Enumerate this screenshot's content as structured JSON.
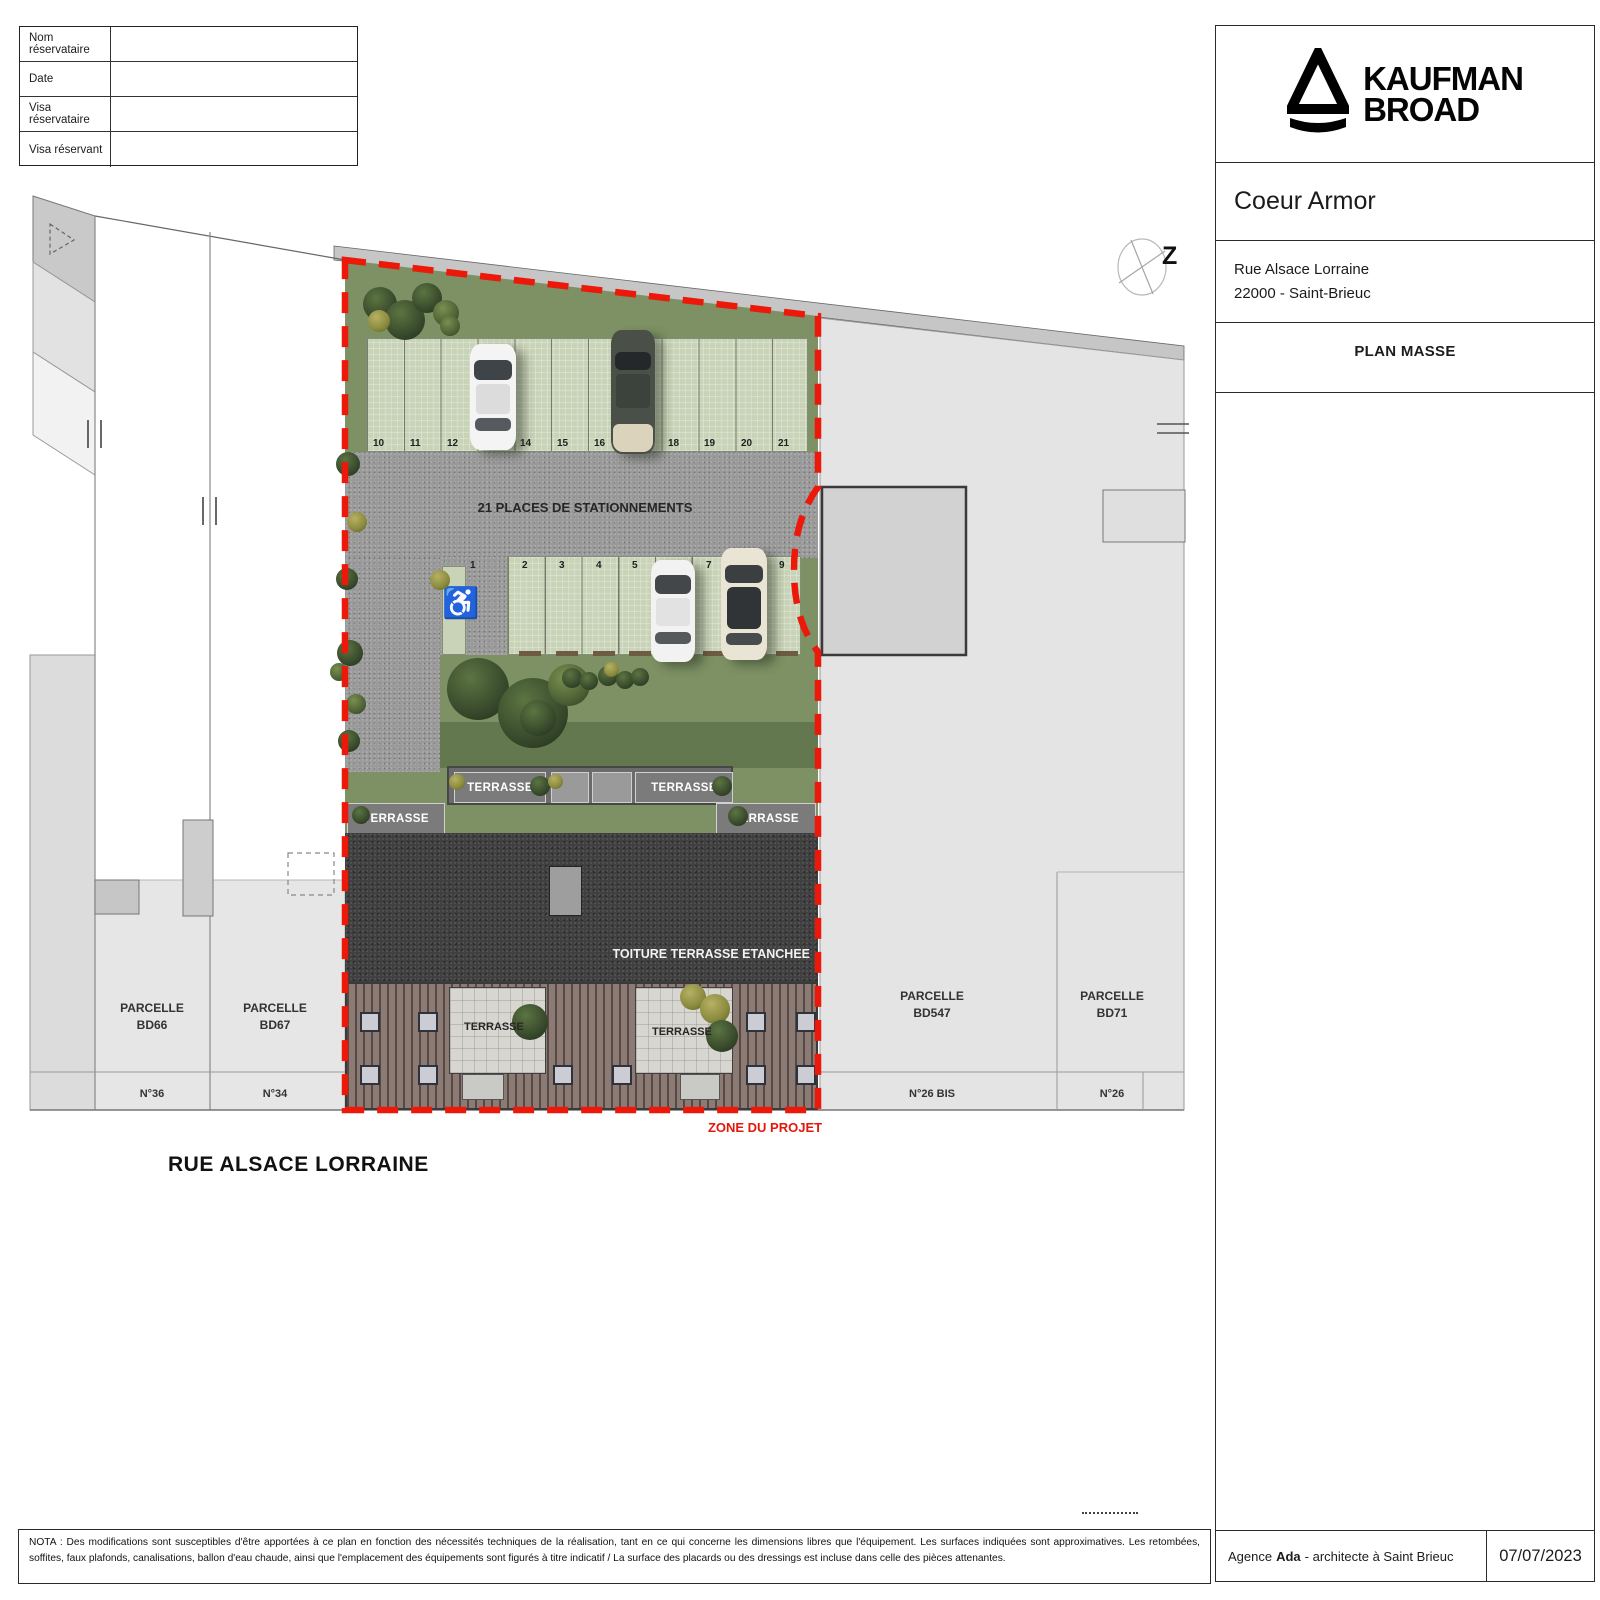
{
  "reservation_table": {
    "rows": [
      "Nom réservataire",
      "Date",
      "Visa réservataire",
      "Visa réservant"
    ]
  },
  "title_block": {
    "brand_top": "KAUFMAN",
    "brand_bottom": "BROAD",
    "project_name": "Coeur Armor",
    "address_line1": "Rue Alsace Lorraine",
    "address_line2": "22000 - Saint-Brieuc",
    "drawing_title": "PLAN MASSE",
    "agency_prefix": "Agence",
    "agency_name": "Ada",
    "agency_suffix": "- architecte à Saint Brieuc",
    "date": "07/07/2023"
  },
  "plan": {
    "parking_title": "21 PLACES DE STATIONNEMENTS",
    "top_stalls": [
      "10",
      "11",
      "12",
      "13",
      "14",
      "15",
      "16",
      "17",
      "18",
      "19",
      "20",
      "21"
    ],
    "bottom_stalls": [
      "1",
      "2",
      "3",
      "4",
      "5",
      "6",
      "7",
      "8",
      "9"
    ],
    "terrasse_label": "TERRASSE",
    "roof_label": "TOITURE TERRASSE ETANCHEE",
    "zone_label": "ZONE DU PROJET",
    "street_label": "RUE ALSACE LORRAINE",
    "north_letter": "Z",
    "icons": {
      "handicap": "♿"
    },
    "parcels": [
      {
        "label": "PARCELLE",
        "id": "BD66",
        "street_no": "N°36"
      },
      {
        "label": "PARCELLE",
        "id": "BD67",
        "street_no": "N°34"
      },
      {
        "label": "PARCELLE",
        "id": "BD547",
        "street_no": "N°26 BIS"
      },
      {
        "label": "PARCELLE",
        "id": "BD71",
        "street_no": "N°26"
      }
    ]
  },
  "nota": {
    "text": "NOTA :  Des modifications sont susceptibles d'être apportées à ce plan en fonction des nécessités techniques de la réalisation, tant en ce qui concerne les dimensions libres que l'équipement.  Les surfaces indiquées sont approximatives.  Les retombées, soffites, faux plafonds, canalisations, ballon d'eau chaude, ainsi que l'emplacement des équipements sont figurés à titre indicatif / La surface des placards ou des dressings est incluse dans celle des pièces attenantes."
  },
  "colors": {
    "zone_boundary_red": "#EC1809",
    "grass_green": "#7D9164",
    "paver_green": "#C9D3B7",
    "asphalt_gray": "#9A9A9A",
    "roof_dark": "#424242",
    "parcel_gray": "#E4E4E4"
  }
}
